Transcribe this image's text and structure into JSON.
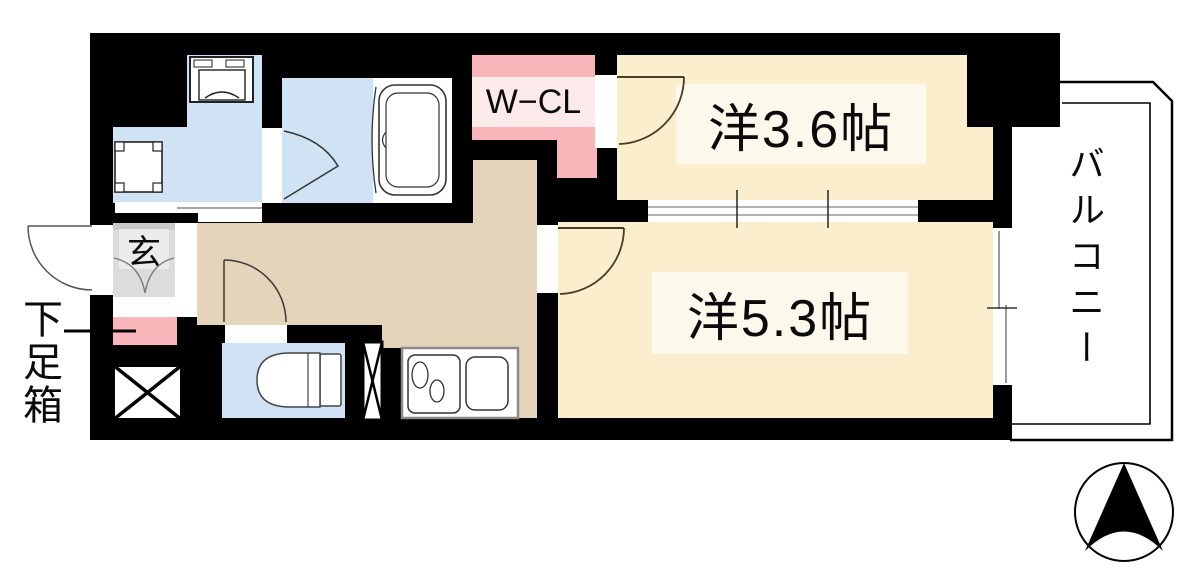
{
  "diagram": {
    "type": "apartment-floor-plan",
    "rooms": {
      "western_room_36": {
        "label": "洋3.6帖"
      },
      "western_room_53": {
        "label": "洋5.3帖"
      },
      "walk_in_closet": {
        "label": "W−CL"
      },
      "entrance": {
        "label": "玄"
      },
      "shoe_box": {
        "label": "下足箱"
      },
      "balcony": {
        "label": "バルコニー"
      }
    },
    "fixtures": [
      "washing-machine",
      "sink",
      "bathtub",
      "toilet",
      "kitchen-stove",
      "kitchen-sink",
      "pipe-space",
      "pipe-space-narrow"
    ],
    "compass": {
      "icon": "north-arrow",
      "direction": "up"
    },
    "colors": {
      "wall": "#000000",
      "room_cream": "#faeecd",
      "label_cream": "#fdf8ec",
      "hallway_tan": "#e4d4ba",
      "water_blue": "#d0e3f5",
      "closet_pink": "#f8b6ba",
      "closet_pink_light": "#fce9e9",
      "entrance_gray": "#dcdcdc",
      "entrance_gray_light": "#ebebeb",
      "door_arc_brown": "#4a3b28",
      "window_gray": "#999999"
    }
  }
}
